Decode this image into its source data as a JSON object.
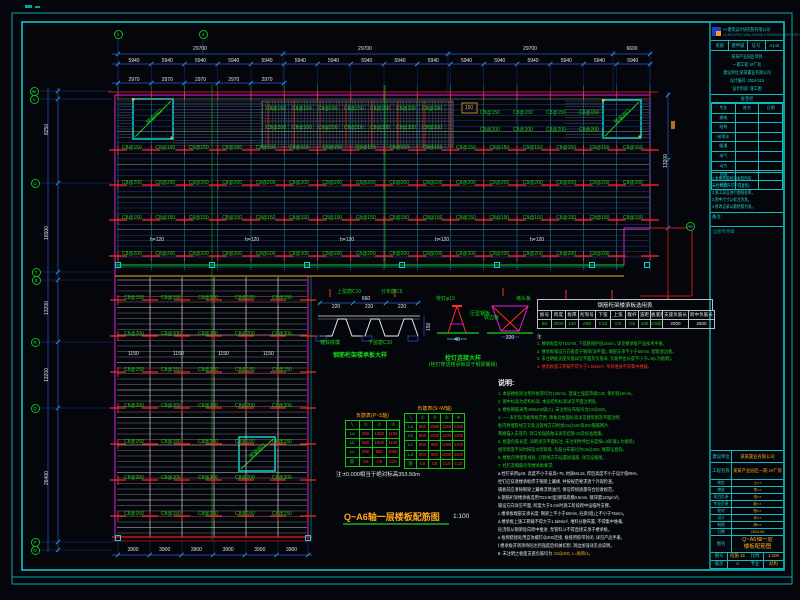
{
  "colors": {
    "frame": "#0fd3d3",
    "dim_blue": "#2f56cf",
    "green": "#1bd41b",
    "red": "#ff3226",
    "magenta": "#e020e0",
    "orange": "#ffa81e",
    "cyan": "#22d3d3",
    "white": "#dfe4ea"
  },
  "plan": {
    "opening_label": "预留洞口",
    "grid_bubbles": [
      {
        "x": 118,
        "y": 34,
        "l": "1"
      },
      {
        "x": 203,
        "y": 34,
        "l": "4"
      },
      {
        "x": 34,
        "y": 91,
        "l": "W"
      },
      {
        "x": 34,
        "y": 99,
        "l": "V"
      },
      {
        "x": 35,
        "y": 183,
        "l": "U"
      },
      {
        "x": 36,
        "y": 272,
        "l": "T"
      },
      {
        "x": 36,
        "y": 280,
        "l": "S"
      },
      {
        "x": 35,
        "y": 342,
        "l": "R"
      },
      {
        "x": 35,
        "y": 408,
        "l": "Q"
      },
      {
        "x": 35,
        "y": 542,
        "l": "P"
      },
      {
        "x": 35,
        "y": 550,
        "l": "N"
      },
      {
        "x": 690,
        "y": 226,
        "l": "A6"
      }
    ],
    "scatter_rows": [
      {
        "y": 146,
        "x0": 122,
        "dx": 33.4,
        "n": 16,
        "t": "C8@150",
        "c": "g"
      },
      {
        "y": 181,
        "x0": 122,
        "dx": 33.4,
        "n": 16,
        "t": "C8@200",
        "c": "g"
      },
      {
        "y": 216,
        "x0": 122,
        "dx": 33.4,
        "n": 16,
        "t": "C8@150",
        "c": "g"
      },
      {
        "y": 252,
        "x0": 122,
        "dx": 33.4,
        "n": 15,
        "t": "C8@200",
        "c": "g"
      },
      {
        "y": 107,
        "x0": 266,
        "dx": 26,
        "n": 7,
        "t": "C8@150",
        "c": "g"
      },
      {
        "y": 126,
        "x0": 266,
        "dx": 26,
        "n": 7,
        "t": "C8@200",
        "c": "g"
      },
      {
        "y": 111,
        "x0": 480,
        "dx": 33,
        "n": 4,
        "t": "C8@150",
        "c": "g"
      },
      {
        "y": 128,
        "x0": 480,
        "dx": 33,
        "n": 4,
        "t": "C8@200",
        "c": "g"
      },
      {
        "y": 238,
        "x0": 150,
        "dx": 95,
        "n": 5,
        "t": "h=120",
        "c": "w"
      },
      {
        "y": 296,
        "x0": 124,
        "dx": 37,
        "n": 5,
        "t": "C8@150",
        "c": "g"
      },
      {
        "y": 332,
        "x0": 124,
        "dx": 37,
        "n": 5,
        "t": "C8@200",
        "c": "g"
      },
      {
        "y": 368,
        "x0": 124,
        "dx": 37,
        "n": 5,
        "t": "C8@150",
        "c": "g"
      },
      {
        "y": 404,
        "x0": 124,
        "dx": 37,
        "n": 5,
        "t": "C8@200",
        "c": "g"
      },
      {
        "y": 440,
        "x0": 124,
        "dx": 37,
        "n": 5,
        "t": "C8@150",
        "c": "g"
      },
      {
        "y": 476,
        "x0": 124,
        "dx": 37,
        "n": 5,
        "t": "C8@200",
        "c": "g"
      },
      {
        "y": 512,
        "x0": 124,
        "dx": 37,
        "n": 5,
        "t": "C8@150",
        "c": "g"
      },
      {
        "y": 352,
        "x0": 128,
        "dx": 45,
        "n": 4,
        "t": "1150",
        "c": "w"
      },
      {
        "y": 59,
        "x0": 134,
        "dx": 33.25,
        "n": 16,
        "t": "5940",
        "c": "w",
        "ctr": 1
      },
      {
        "y": 78,
        "x0": 134,
        "dx": 33.25,
        "n": 5,
        "t": "2970",
        "c": "w",
        "ctr": 1
      },
      {
        "y": 548,
        "x0": 133,
        "dx": 31.7,
        "n": 6,
        "t": "3900",
        "c": "w",
        "ctr": 1
      }
    ],
    "scatter": [
      {
        "x": 200,
        "y": 47,
        "t": "29700",
        "c": "w",
        "ctr": 1
      },
      {
        "x": 365,
        "y": 47,
        "t": "29700",
        "c": "w",
        "ctr": 1
      },
      {
        "x": 530,
        "y": 47,
        "t": "29700",
        "c": "w",
        "ctr": 1
      },
      {
        "x": 632,
        "y": 47,
        "t": "6600",
        "c": "w",
        "ctr": 1
      },
      {
        "x": 45,
        "y": 135,
        "t": "8250",
        "c": "w",
        "rot": 1
      },
      {
        "x": 45,
        "y": 240,
        "t": "16500",
        "c": "w",
        "rot": 1
      },
      {
        "x": 45,
        "y": 315,
        "t": "13200",
        "c": "w",
        "rot": 1
      },
      {
        "x": 45,
        "y": 382,
        "t": "13200",
        "c": "w",
        "rot": 1
      },
      {
        "x": 45,
        "y": 485,
        "t": "26400",
        "c": "w",
        "rot": 1
      },
      {
        "x": 664,
        "y": 168,
        "t": "13200",
        "c": "w",
        "rot": 1
      },
      {
        "x": 469,
        "y": 106,
        "t": "150",
        "c": "o",
        "ctr": 1
      },
      {
        "x": 337,
        "y": 290,
        "t": "上弦筋C10",
        "c": "g"
      },
      {
        "x": 381,
        "y": 290,
        "t": "分布筋C6",
        "c": "g"
      },
      {
        "x": 320,
        "y": 341,
        "t": "镀锌底模",
        "c": "g"
      },
      {
        "x": 368,
        "y": 341,
        "t": "下弦筋C10",
        "c": "g"
      },
      {
        "x": 366,
        "y": 297,
        "t": "660",
        "c": "w",
        "ctr": 1
      },
      {
        "x": 336,
        "y": 305,
        "t": "220",
        "c": "w",
        "ctr": 1
      },
      {
        "x": 369,
        "y": 305,
        "t": "220",
        "c": "w",
        "ctr": 1
      },
      {
        "x": 402,
        "y": 305,
        "t": "220",
        "c": "w",
        "ctr": 1
      },
      {
        "x": 427,
        "y": 331,
        "t": "150",
        "c": "w",
        "rot": 1
      },
      {
        "x": 436,
        "y": 297,
        "t": "栓钉φ19",
        "c": "g"
      },
      {
        "x": 470,
        "y": 312,
        "t": "压型钢板",
        "c": "g"
      },
      {
        "x": 516,
        "y": 297,
        "t": "堵头板",
        "c": "g"
      },
      {
        "x": 484,
        "y": 316,
        "t": "收边板",
        "c": "g"
      },
      {
        "x": 457,
        "y": 338,
        "t": "40",
        "c": "w",
        "ctr": 1
      },
      {
        "x": 510,
        "y": 336,
        "t": "220",
        "c": "w",
        "ctr": 1
      }
    ]
  },
  "details": {
    "deck_caption": "钢筋桁架楼承板大样",
    "stud_caption1": "栓钉连接大样",
    "stud_caption2": "(栓钉穿透楼承板焊于钢梁翼缘)"
  },
  "selection_table": {
    "title": "钢筋桁架楼承板选用表",
    "headers": [
      "板号",
      "跨度",
      "板厚",
      "桁架号",
      "下弦",
      "上弦",
      "腹杆",
      "波距",
      "板底筋",
      "支座负筋长",
      "跨中负筋长"
    ],
    "row": [
      "B1",
      "3000",
      "120",
      "A90",
      "C10",
      "C8",
      "C5",
      "190",
      "C8@200",
      "2000",
      "2500"
    ]
  },
  "table_notes": {
    "lines": [
      {
        "t": "注:",
        "c": "w"
      },
      {
        "t": "1. 楼承板型号TD3-90, 下弦筋保护层15mm, 详见楼承板产品技术手册。",
        "c": "g"
      },
      {
        "t": "2. 楼承板铺设方向垂直于钢梁(详平面), 端部支承不小于50mm, 配套收边板。",
        "c": "g"
      },
      {
        "t": "3. 未注明板支座负筋详见平面及负筋表, 负筋伸出长度不小于L/4(L为板跨)。",
        "c": "g"
      },
      {
        "t": "4. 楼承板施工荷载不得大于1.5kN/m², 吊装堆放不得集中堆载。",
        "c": "r"
      }
    ]
  },
  "main_notes": {
    "header": "说明:",
    "lines": [
      {
        "t": "1. 本层楼板除注明外板厚均为120mm, 混凝土强度等级C30, 保护层15mm。",
        "c": "g"
      },
      {
        "t": "2. 图中标高为结构标高, 本层结构标高详见平面注明处。",
        "c": "g"
      },
      {
        "t": "3. 楼板钢筋采用HRB400级(C), 未注明分布筋均为C8@250。",
        "c": "g"
      },
      {
        "t": "4. ── 表示现浇板降板范围, 降板处板面标高详见建筑图及平面注明,",
        "c": "g"
      },
      {
        "t": "    板内预埋管线交叉处沿管线方向附加C6@150宽500钢筋网片,",
        "c": "g"
      },
      {
        "t": "    两端锚入支座内, 洞口加强筋做法详见结施-02及标准图集。",
        "c": "g"
      },
      {
        "t": "5. 板面负筋长度, 间距详见平面标注, 未注明时伸出长度按L/4取值(L为板跨),",
        "c": "g"
      },
      {
        "t": "    相邻跨度不同时按较大跨取值, 负筋分布筋均为C8@250, 端部设直钩。",
        "c": "g"
      },
      {
        "t": "6. 楼板内预埋管线处, 沿管线方向设置加强筋, 详见设备图。",
        "c": "g"
      },
      {
        "t": "7. 栓钉及钢筋桁架楼承板要求:",
        "c": "g"
      },
      {
        "t": "a.栓钉采用φ19, 高度不小于波高+75, 材质ML15, 焊后高度不小于设计值95%,",
        "c": "w"
      },
      {
        "t": "   栓钉应穿透楼承板焊于钢梁上翼缘, 并按规范要求逐个外观检查。",
        "c": "w"
      },
      {
        "t": "   铺板前应清除钢梁上翼缘浮锈油污, 保证焊接质量符合验收规范。",
        "c": "w"
      },
      {
        "t": "b.钢筋桁架楼承板选用TD3-90型(镀锌底模0.5mm, 镀锌量120g/m²),",
        "c": "w"
      },
      {
        "t": "   铺设方向详见平面, 跨度大于3.0m时施工阶段跨中设临时支撑。",
        "c": "w"
      },
      {
        "t": "c.楼承板端部支承长度: 钢梁上不小于50mm, 砼梁(墙)上不小于75mm。",
        "c": "w"
      },
      {
        "t": "d.楼承板上施工荷载不得大于1.5kN/m², 堆料分散布置, 不得集中堆载,",
        "c": "w"
      },
      {
        "t": "   砼浇筑从钢梁处向跨中推进, 泵管料斗不得直接支承于楼承板。",
        "c": "w"
      },
      {
        "t": "e.板侧搭接处用自攻螺钉@300连接, 板缝用胶带封闭, 详见产品手册。",
        "c": "w"
      },
      {
        "t": "f.楼承板开洞须待砼达到强度后机械切割, 洞边加强详见总说明。",
        "c": "w"
      },
      {
        "t": "8. 未注明之板面支座负筋均为 ",
        "c": "w",
        "tail": "C8@200, L=板跨/4。",
        "tailc": "o"
      }
    ]
  },
  "neg_tables": {
    "left": {
      "title": "负筋表(P~S轴)",
      "header": [
        "╲",
        "①",
        "②",
        "③"
      ],
      "rows": [
        [
          "La",
          "950",
          "1050",
          "1150"
        ],
        [
          "Lb",
          "900",
          "1000",
          "1100"
        ],
        [
          "Lc",
          "850",
          "950",
          "1050"
        ],
        [
          "筋",
          "C8",
          "C8",
          "C10"
        ]
      ]
    },
    "right": {
      "title": "负筋表(S~W轴)",
      "header": [
        "╲",
        "①",
        "②",
        "③",
        "④"
      ],
      "rows": [
        [
          "La",
          "950",
          "1050",
          "1150",
          "1250"
        ],
        [
          "Lb",
          "900",
          "1000",
          "1100",
          "1200"
        ],
        [
          "Lc",
          "850",
          "950",
          "1050",
          "1150"
        ],
        [
          "Ld",
          "800",
          "900",
          "1000",
          "1100"
        ],
        [
          "筋",
          "C8",
          "C8",
          "C10",
          "C10"
        ]
      ]
    },
    "note": "注:±0.000相当于绝对标高353.50m"
  },
  "drawing_title": {
    "text": "Q~A6轴一层楼板配筋图",
    "scale": "1:100"
  },
  "title_block": {
    "company": "××建筑设计研究院有限公司",
    "company_en": "XX ARCHITECTURAL DESIGN & RESEARCH INSTITUTE CO.,LTD.",
    "cert_cells": [
      "资质",
      "建甲级",
      "证号",
      "A142"
    ],
    "project_lines": [
      "某某产业园区项目",
      "一期工程 1#厂房",
      "建设单位:某某置业有限公司",
      "设计编号: 2024-015",
      "设计阶段: 施工图"
    ],
    "sign_title": "会签栏",
    "sign_header": [
      "专业",
      "姓名",
      "日期"
    ],
    "sign_rows": [
      "建筑",
      "结构",
      "给排水",
      "暖通",
      "电气",
      "动力",
      "总图",
      "经济"
    ],
    "notice_lines": [
      "1.本图纸版权归本院所有,",
      "  未经书面许可不得复制。",
      "2.施工前应进行图纸会审。",
      "3.图中尺寸以标注为准。",
      "4.修改记录以最终版为准。"
    ],
    "remark_label": "备注:",
    "stamp_label": "出图专用章",
    "owner_label": "建设单位",
    "owner": "某某置业有限公司",
    "project_label": "工程名称",
    "project": "某某产业园区一期 1#厂房",
    "kv_rows": [
      [
        "审定",
        "王××"
      ],
      [
        "审核",
        "李××"
      ],
      [
        "项目负责",
        "张××"
      ],
      [
        "专业负责",
        "赵××"
      ],
      [
        "校对",
        "钱××"
      ],
      [
        "设计",
        "孙××"
      ],
      [
        "制图",
        "周××"
      ],
      [
        "日期",
        "2024.06"
      ]
    ],
    "figname_label": "图名",
    "figname1": "Q~A6轴一层",
    "figname2": "楼板配筋图",
    "bottom_cells": [
      [
        "图号",
        "结施-15"
      ],
      [
        "比例",
        "1:100"
      ],
      [
        "版次",
        "A"
      ],
      [
        "专业",
        "结构"
      ]
    ]
  }
}
